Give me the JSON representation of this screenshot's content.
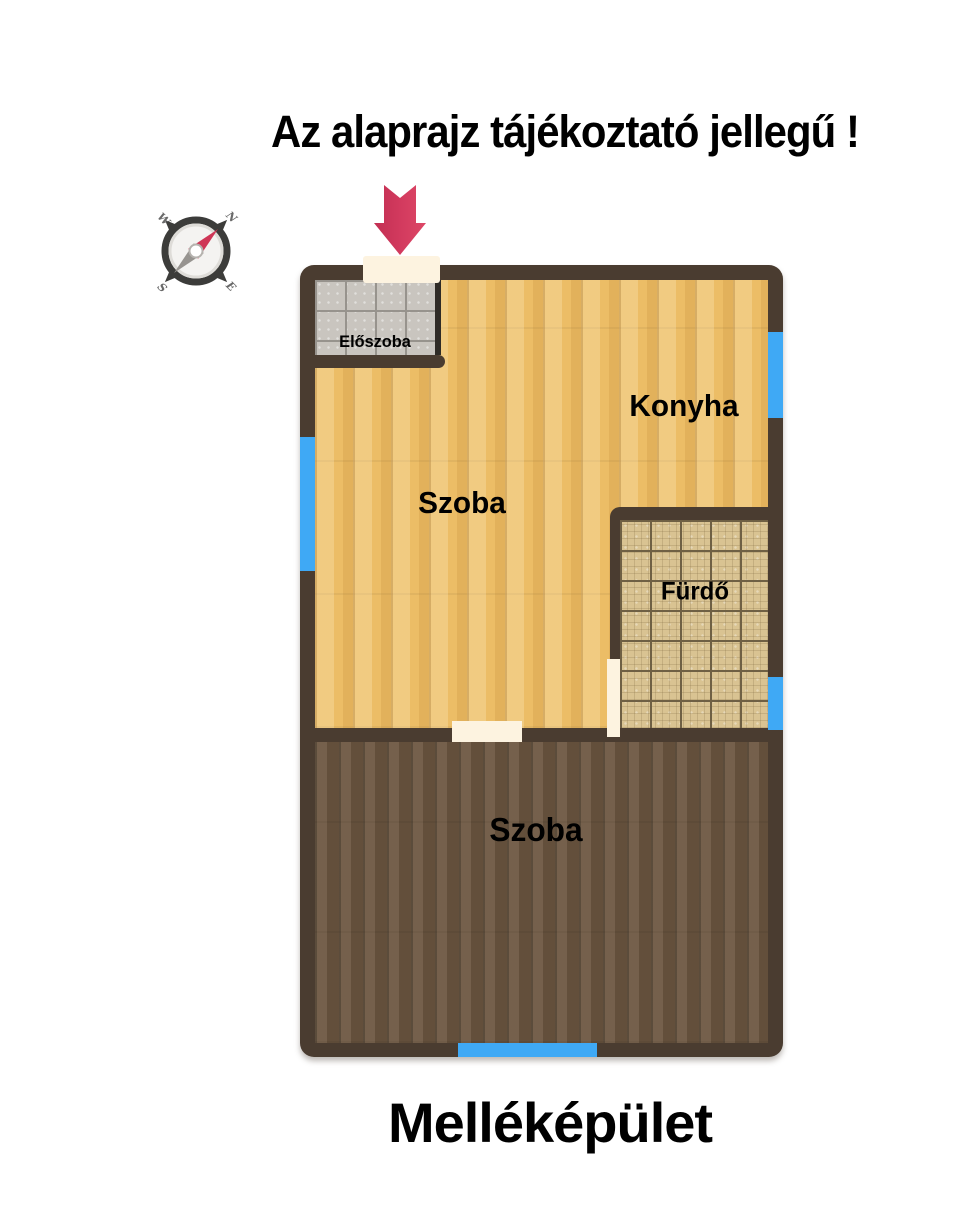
{
  "title": "Az alaprajz tájékoztató jellegű !",
  "building_label": "Melléképület",
  "compass": {
    "labels": {
      "nw": "W",
      "ne": "N",
      "sw": "S",
      "se": "E"
    }
  },
  "rooms": {
    "eloszoba": {
      "label": "Előszoba"
    },
    "szoba_upper": {
      "label": "Szoba"
    },
    "konyha": {
      "label": "Konyha"
    },
    "furdo": {
      "label": "Fürdő"
    },
    "szoba_lower": {
      "label": "Szoba"
    }
  },
  "colors": {
    "wall": "#4a3c30",
    "wall_dark": "#2f2b26",
    "window": "#3fa9f5",
    "door_opening": "#fdf3e0",
    "light_floor": "#ecbd66",
    "dark_floor": "#6e5842",
    "hall_tile": "#c9c5bf",
    "hall_grout": "#97938d",
    "bath_tile": "#d9c392",
    "bath_grout": "#6f6044",
    "arrow_red": "#d23a5e",
    "text": "#000000"
  }
}
